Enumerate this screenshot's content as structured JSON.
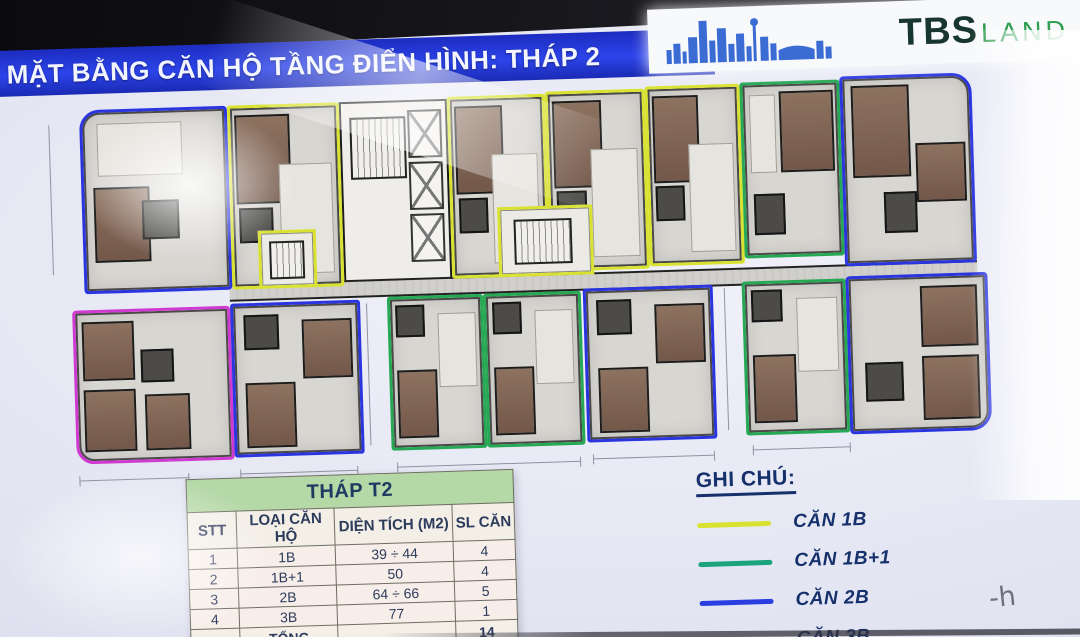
{
  "header": {
    "title": "MẶT BẰNG CĂN HỘ TẦNG ĐIỂN HÌNH: THÁP 2",
    "title_bg": "#2438d6",
    "brand": {
      "tbs": "TBS",
      "land": "LAND",
      "tbs_color": "#17362d",
      "land_color": "#2f9e50"
    }
  },
  "table": {
    "title": "THÁP T2",
    "columns": [
      "STT",
      "LOẠI CĂN HỘ",
      "DIỆN TÍCH (M2)",
      "SL CĂN"
    ],
    "col_widths": [
      46,
      100,
      122,
      60
    ],
    "rows": [
      [
        "1",
        "1B",
        "39 ÷ 44",
        "4"
      ],
      [
        "2",
        "1B+1",
        "50",
        "4"
      ],
      [
        "3",
        "2B",
        "64 ÷ 66",
        "5"
      ],
      [
        "4",
        "3B",
        "77",
        "1"
      ]
    ],
    "total_row": [
      "",
      "TỔNG",
      "",
      "14"
    ]
  },
  "legend": {
    "title": "GHI CHÚ:",
    "items": [
      {
        "label": "CĂN 1B",
        "color": "#d9e231"
      },
      {
        "label": "CĂN 1B+1",
        "color": "#1ba37c"
      },
      {
        "label": "CĂN 2B",
        "color": "#2b3fe0"
      },
      {
        "label": "CĂN 3B",
        "color": "#b279e2"
      }
    ]
  },
  "plan": {
    "outline_colors": {
      "yellow": "#d9e231",
      "green": "#27a855",
      "blue": "#2a35e0",
      "magenta": "#cf3bd0"
    },
    "units": [
      {
        "id": "unit-2b-top-left",
        "type": "2B",
        "color": "blue",
        "x": 25,
        "y": 12,
        "w": 148,
        "h": 184,
        "r": "tl",
        "v": "tBlueL"
      },
      {
        "id": "unit-1b-top-1",
        "type": "1B",
        "color": "yellow",
        "x": 173,
        "y": 12,
        "w": 112,
        "h": 184,
        "r": "",
        "v": "tA"
      },
      {
        "id": "unit-1b-top-2",
        "type": "1B",
        "color": "yellow",
        "x": 393,
        "y": 10,
        "w": 98,
        "h": 182,
        "r": "",
        "v": "tA"
      },
      {
        "id": "unit-1b-top-3",
        "type": "1B",
        "color": "yellow",
        "x": 491,
        "y": 8,
        "w": 100,
        "h": 180,
        "r": "",
        "v": "tA"
      },
      {
        "id": "unit-1b-top-4",
        "type": "1B",
        "color": "yellow",
        "x": 591,
        "y": 6,
        "w": 95,
        "h": 180,
        "r": "",
        "v": "tA"
      },
      {
        "id": "unit-1b1-top",
        "type": "1B+1",
        "color": "green",
        "x": 686,
        "y": 5,
        "w": 100,
        "h": 176,
        "r": "",
        "v": "tGreen"
      },
      {
        "id": "unit-2b-top-right",
        "type": "2B",
        "color": "blue",
        "x": 786,
        "y": 2,
        "w": 132,
        "h": 190,
        "r": "tr",
        "v": "tBlueR"
      },
      {
        "id": "unit-3b-bottom-left",
        "type": "3B",
        "color": "magenta",
        "x": 12,
        "y": 212,
        "w": 158,
        "h": 154,
        "r": "bl",
        "v": "bMag"
      },
      {
        "id": "unit-2b-bottom-1",
        "type": "2B",
        "color": "blue",
        "x": 170,
        "y": 210,
        "w": 130,
        "h": 154,
        "r": "",
        "v": "bBlue"
      },
      {
        "id": "unit-1b1-bottom-1",
        "type": "1B+1",
        "color": "green",
        "x": 327,
        "y": 208,
        "w": 96,
        "h": 154,
        "r": "",
        "v": "bGreen"
      },
      {
        "id": "unit-1b1-bottom-2",
        "type": "1B+1",
        "color": "green",
        "x": 423,
        "y": 208,
        "w": 98,
        "h": 154,
        "r": "",
        "v": "bGreen"
      },
      {
        "id": "unit-2b-bottom-2",
        "type": "2B",
        "color": "blue",
        "x": 523,
        "y": 206,
        "w": 130,
        "h": 154,
        "r": "",
        "v": "bBlue"
      },
      {
        "id": "unit-1b1-bottom-3",
        "type": "1B+1",
        "color": "green",
        "x": 682,
        "y": 204,
        "w": 104,
        "h": 154,
        "r": "",
        "v": "bGreen"
      },
      {
        "id": "unit-2b-bottom-right",
        "type": "2B",
        "color": "blue",
        "x": 786,
        "y": 202,
        "w": 142,
        "h": 158,
        "r": "br",
        "v": "bBlueR"
      }
    ],
    "variants": {
      "tA": [
        {
          "c": "bed",
          "x": 4,
          "y": 4,
          "w": 52,
          "h": 50
        },
        {
          "c": "bath",
          "x": 6,
          "y": 56,
          "w": 32,
          "h": 20
        },
        {
          "c": "patch",
          "x": 44,
          "y": 32,
          "w": 50,
          "h": 62
        }
      ],
      "tGreen": [
        {
          "c": "bed",
          "x": 38,
          "y": 4,
          "w": 58,
          "h": 48
        },
        {
          "c": "bath",
          "x": 8,
          "y": 64,
          "w": 34,
          "h": 24
        },
        {
          "c": "patch",
          "x": 6,
          "y": 6,
          "w": 28,
          "h": 46
        }
      ],
      "tBlueL": [
        {
          "c": "bed",
          "x": 6,
          "y": 42,
          "w": 40,
          "h": 42
        },
        {
          "c": "bath",
          "x": 40,
          "y": 50,
          "w": 26,
          "h": 22
        },
        {
          "c": "patch",
          "x": 10,
          "y": 6,
          "w": 60,
          "h": 30
        }
      ],
      "tBlueR": [
        {
          "c": "bed",
          "x": 6,
          "y": 4,
          "w": 46,
          "h": 50
        },
        {
          "c": "bed",
          "x": 56,
          "y": 36,
          "w": 40,
          "h": 32
        },
        {
          "c": "bath",
          "x": 30,
          "y": 62,
          "w": 26,
          "h": 22
        }
      ],
      "bMag": [
        {
          "c": "bed",
          "x": 4,
          "y": 6,
          "w": 34,
          "h": 40
        },
        {
          "c": "bed",
          "x": 4,
          "y": 52,
          "w": 34,
          "h": 42
        },
        {
          "c": "bed",
          "x": 44,
          "y": 56,
          "w": 30,
          "h": 38
        },
        {
          "c": "bath",
          "x": 42,
          "y": 26,
          "w": 22,
          "h": 22
        }
      ],
      "bBlue": [
        {
          "c": "bed",
          "x": 55,
          "y": 10,
          "w": 40,
          "h": 40
        },
        {
          "c": "bed",
          "x": 8,
          "y": 52,
          "w": 40,
          "h": 44
        },
        {
          "c": "bath",
          "x": 8,
          "y": 6,
          "w": 28,
          "h": 24
        }
      ],
      "bGreen": [
        {
          "c": "bed",
          "x": 6,
          "y": 48,
          "w": 44,
          "h": 46
        },
        {
          "c": "bath",
          "x": 6,
          "y": 4,
          "w": 32,
          "h": 22
        },
        {
          "c": "patch",
          "x": 52,
          "y": 10,
          "w": 42,
          "h": 50
        }
      ],
      "bBlueR": [
        {
          "c": "bed",
          "x": 52,
          "y": 6,
          "w": 42,
          "h": 40
        },
        {
          "c": "bed",
          "x": 52,
          "y": 52,
          "w": 42,
          "h": 42
        },
        {
          "c": "bath",
          "x": 10,
          "y": 55,
          "w": 28,
          "h": 26
        }
      ]
    },
    "annexes": [
      {
        "x": 200,
        "y": 138,
        "w": 58,
        "h": 58
      },
      {
        "x": 440,
        "y": 122,
        "w": 95,
        "h": 70
      }
    ]
  },
  "handwriting": "-h"
}
